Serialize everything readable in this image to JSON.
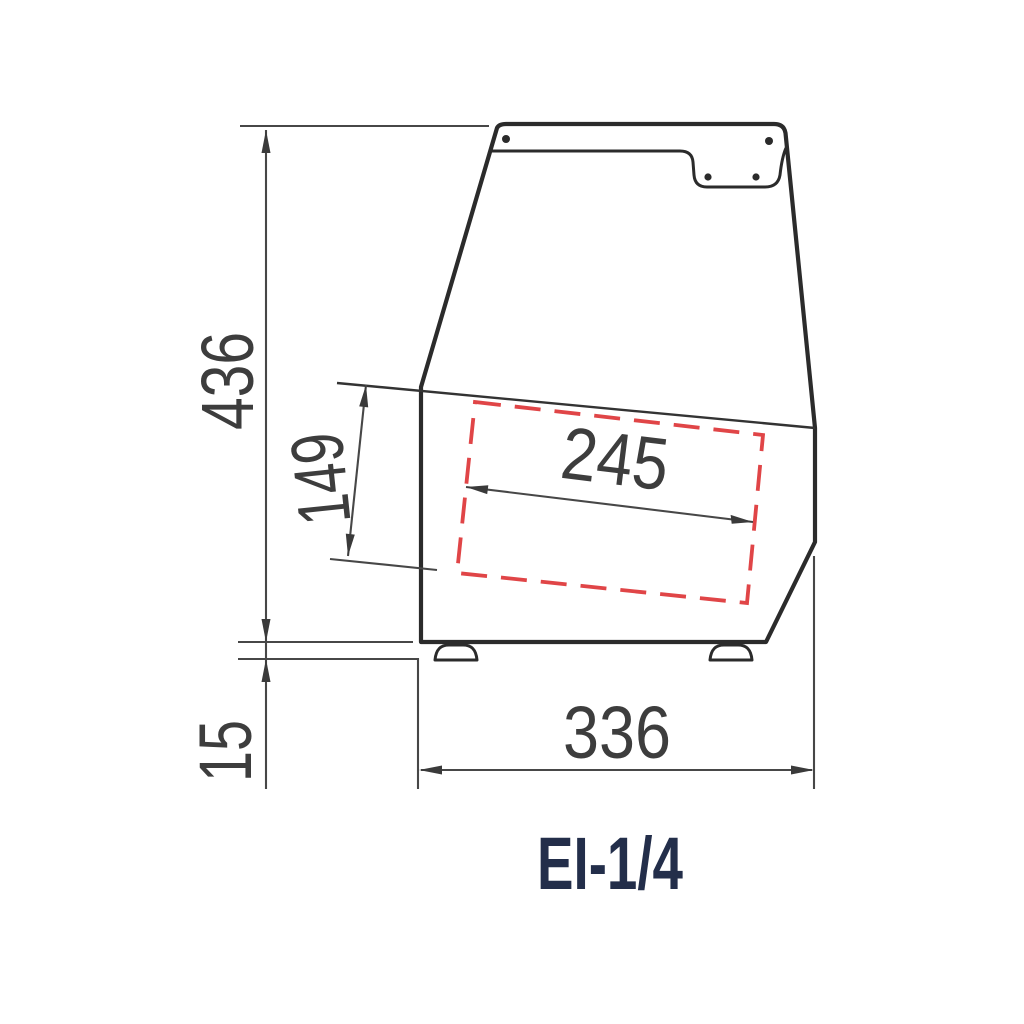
{
  "drawing": {
    "title": "EI-1/4",
    "dimensions": {
      "height_total": "436",
      "pan_depth": "149",
      "pan_width": "245",
      "base_width": "336",
      "foot_height": "15"
    },
    "colors": {
      "outline": "#2b2b2b",
      "dimension_lines": "#474747",
      "label_text": "#3d3d3d",
      "pan_highlight_red": "#e04547",
      "title_text": "#232e4a",
      "background": "#ffffff"
    }
  }
}
